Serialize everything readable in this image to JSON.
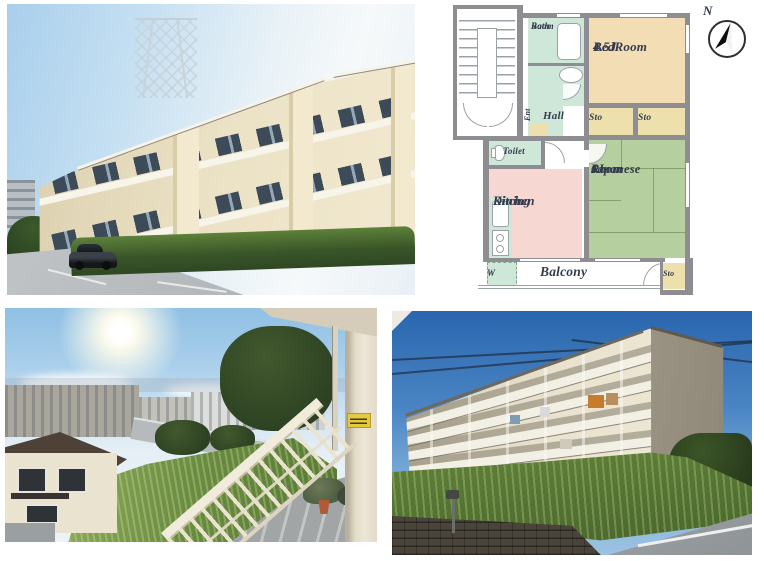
{
  "floorplan": {
    "compass": "N",
    "labels": {
      "bath1": "Bath",
      "bath2": "Room",
      "bedroom1": "BedRoom",
      "bedroom2": "4.5J",
      "ent": "Ent",
      "hall": "Hall",
      "sto": "Sto",
      "toilet": "Toilet",
      "dk1": "Dining",
      "dk2": "Kitchen",
      "jr1": "Japanese",
      "jr2": "Room",
      "jr3": "6J",
      "balcony": "Balcony",
      "washer": "W"
    },
    "colors": {
      "wall": "#8e8e92",
      "mint": "#cfe7d9",
      "peach": "#f3ddb4",
      "cream": "#eee0ad",
      "pink": "#f6d7d2",
      "green": "#b6cf9e",
      "ink": "#333b4d",
      "line": "#9aa2a6"
    }
  },
  "photos": {
    "exterior_front": "apartment building exterior, front view",
    "balcony_view": "view of neighborhood from balcony",
    "exterior_rear": "apartment building exterior, rear view from below"
  }
}
